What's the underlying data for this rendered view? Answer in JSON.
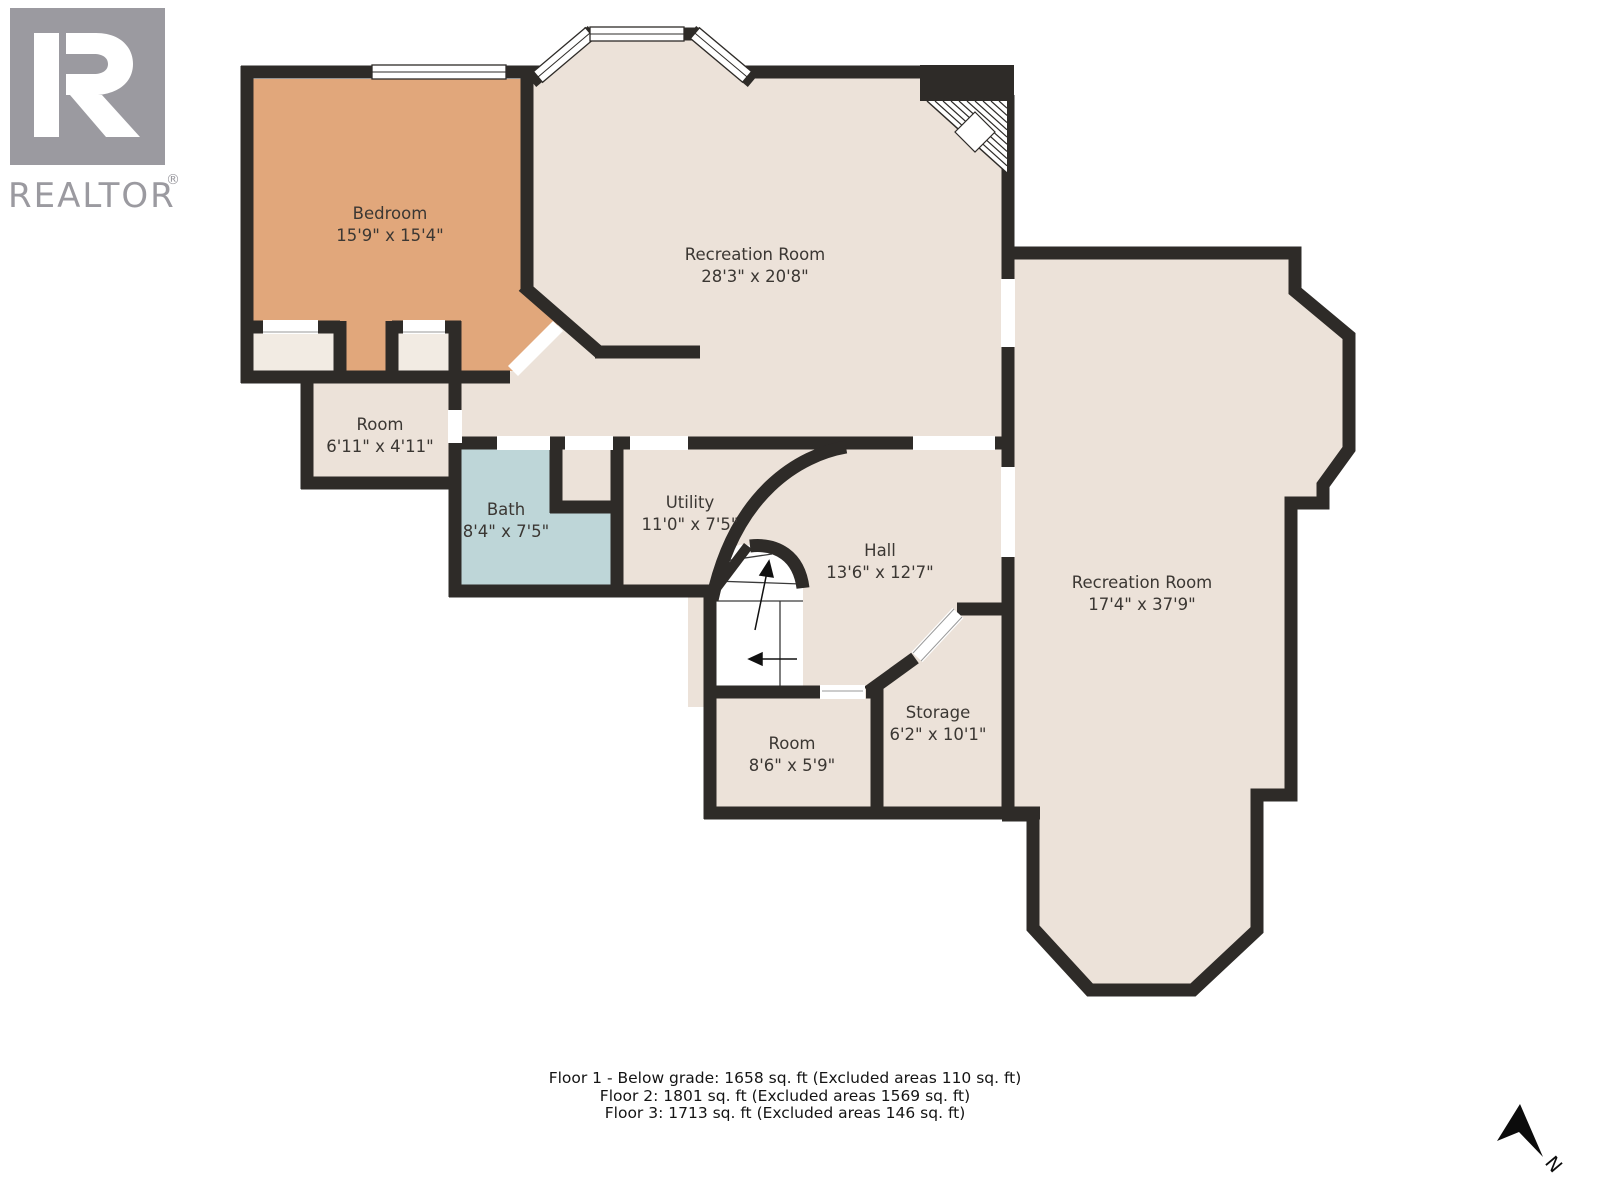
{
  "logo": {
    "mark_letter": "R",
    "wordmark": "REALTOR",
    "registered": "®"
  },
  "floorplan": {
    "rooms": [
      {
        "name": "Bedroom",
        "dims": "15'9\" x 15'4\""
      },
      {
        "name": "Recreation Room",
        "dims": "28'3\" x 20'8\""
      },
      {
        "name": "Room",
        "dims": "6'11\" x 4'11\""
      },
      {
        "name": "Bath",
        "dims": "8'4\" x 7'5\""
      },
      {
        "name": "Utility",
        "dims": "11'0\" x 7'5\""
      },
      {
        "name": "Hall",
        "dims": "13'6\" x 12'7\""
      },
      {
        "name": "Recreation Room",
        "dims": "17'4\" x 37'9\""
      },
      {
        "name": "Room",
        "dims": "8'6\" x 5'9\""
      },
      {
        "name": "Storage",
        "dims": "6'2\" x 10'1\""
      }
    ],
    "compass_label": "N"
  },
  "footer": {
    "lines": [
      "Floor 1 - Below grade: 1658 sq. ft (Excluded areas 110 sq. ft)",
      "Floor 2: 1801 sq. ft (Excluded areas 1569 sq. ft)",
      "Floor 3: 1713 sq. ft (Excluded areas 146 sq. ft)"
    ]
  },
  "colors": {
    "wall": "#2e2b28",
    "floor": "#ece2d9",
    "bedroom": "#e1a77b",
    "bath": "#bed6d8",
    "closet": "#f2ebe3",
    "logo_gray": "#9b9aa0"
  }
}
